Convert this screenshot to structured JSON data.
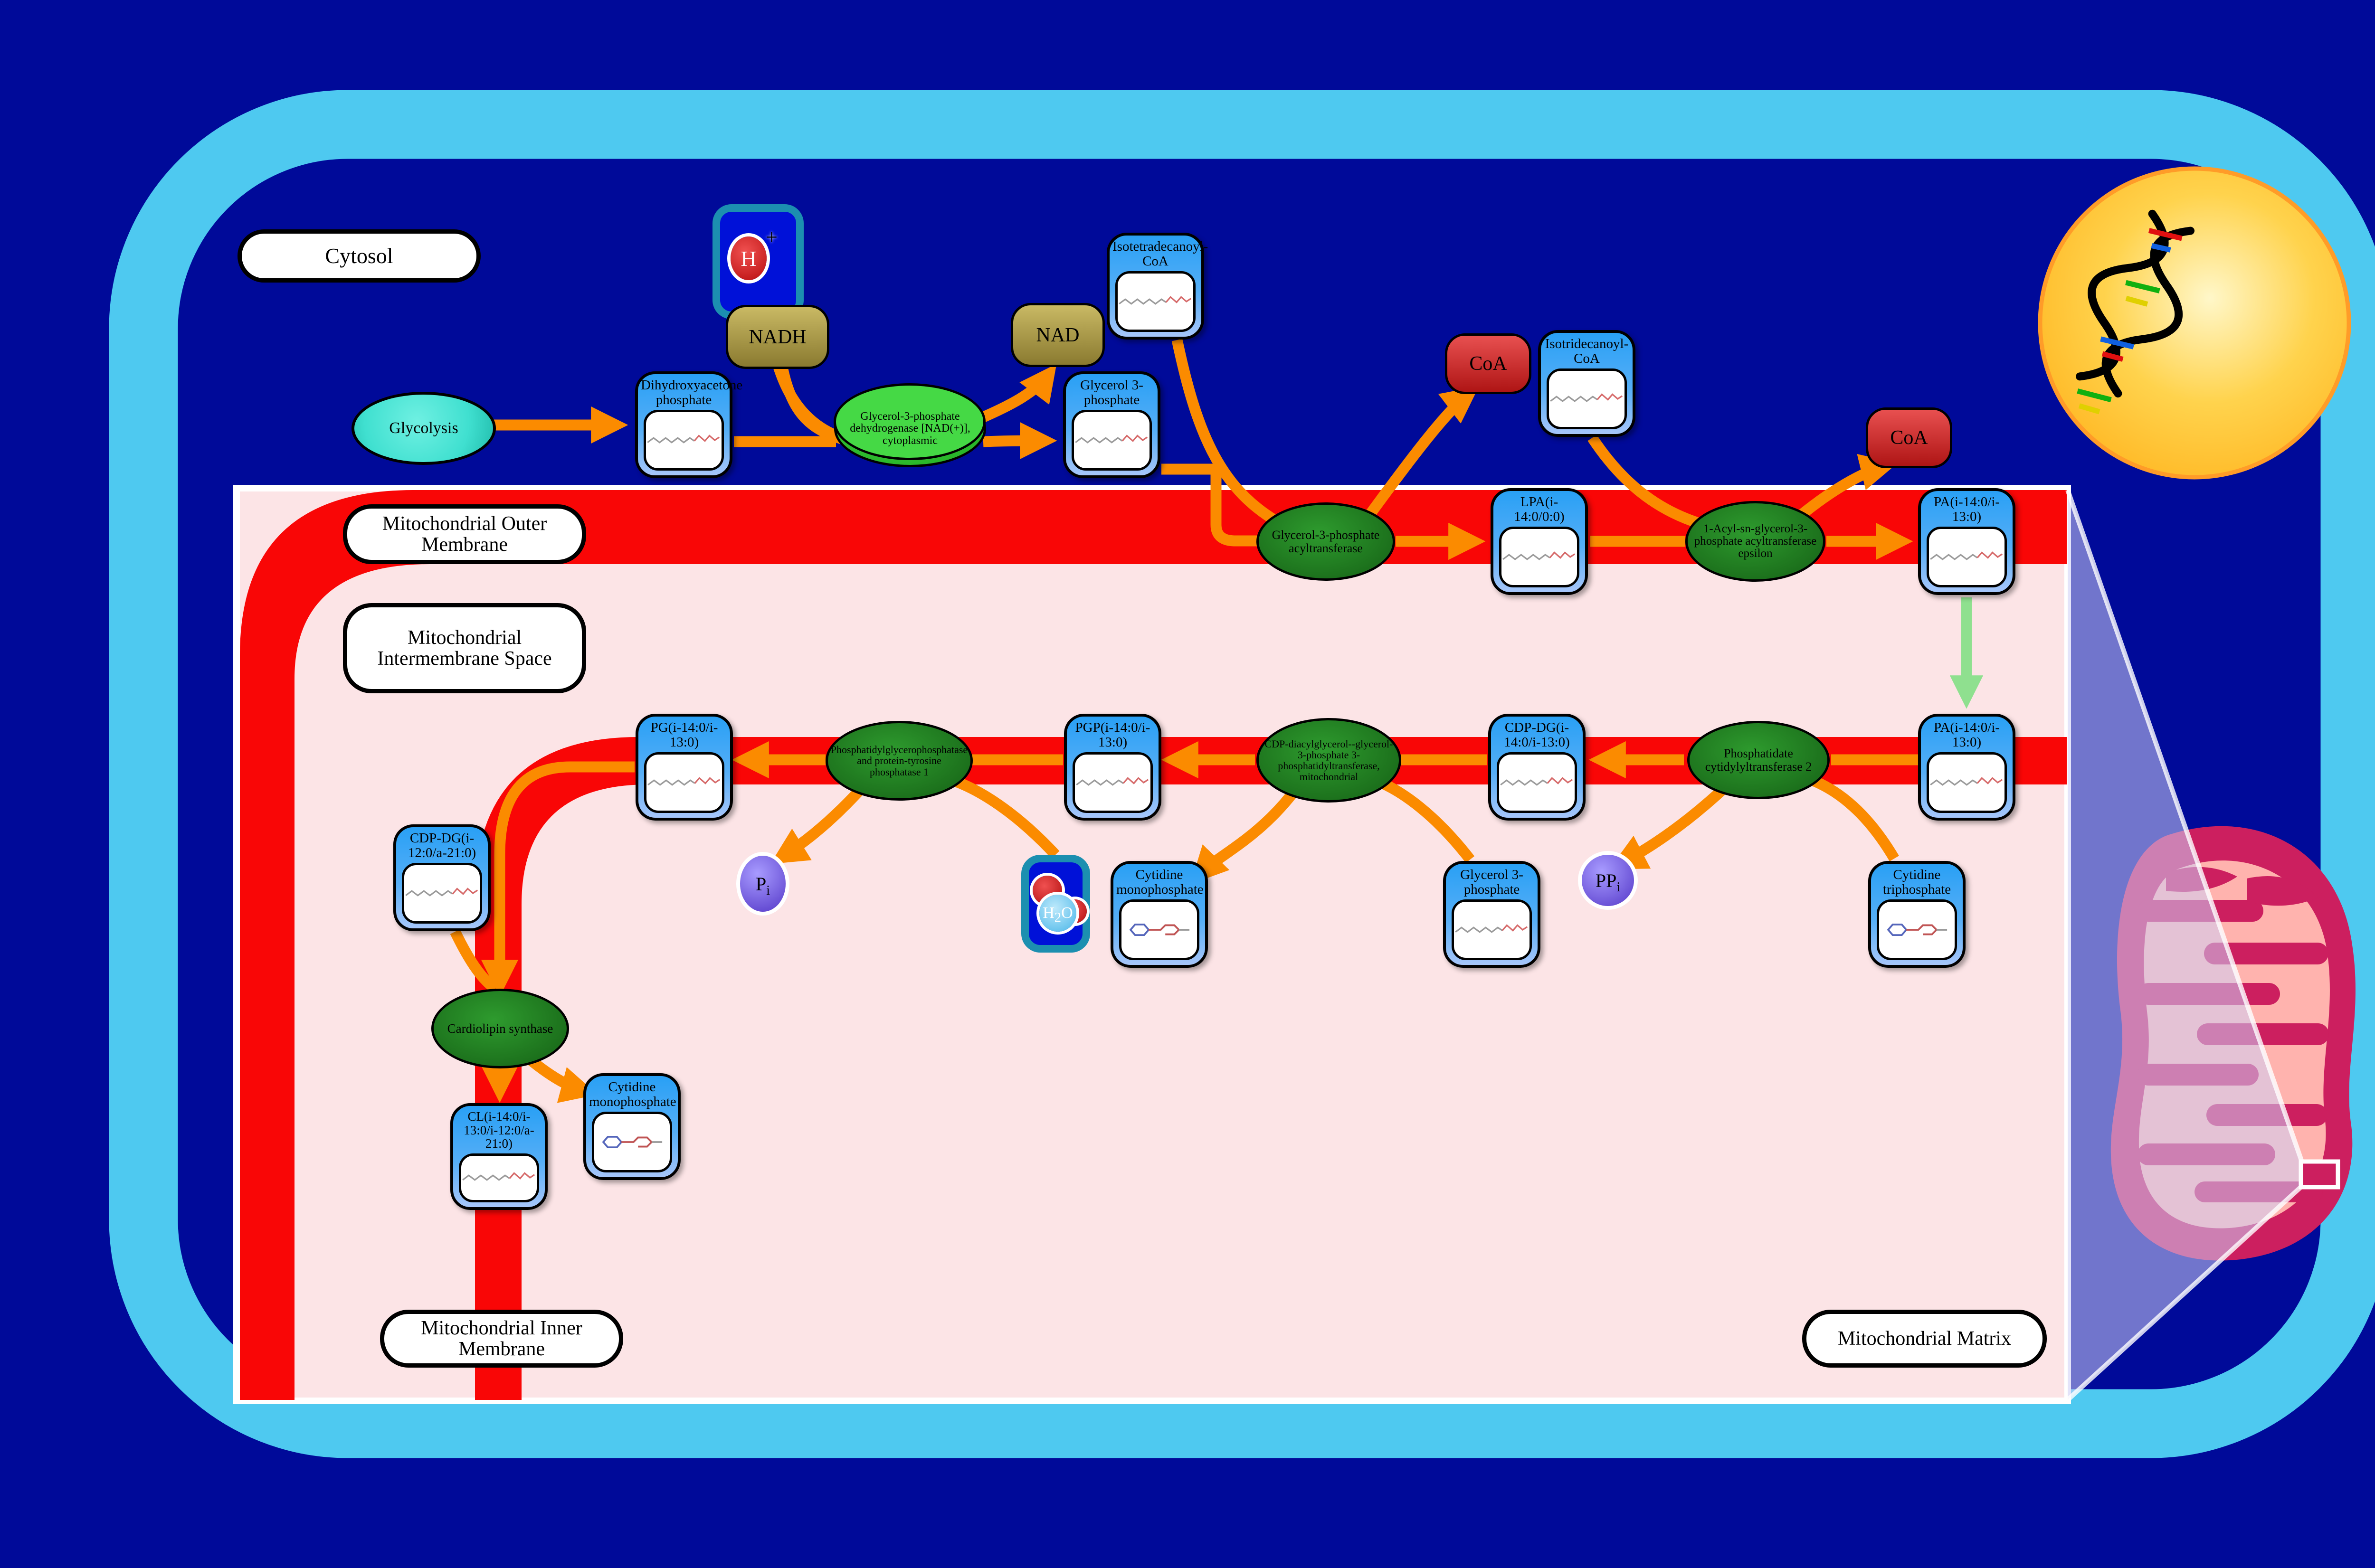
{
  "compartments": {
    "cytosol": "Cytosol",
    "outer_membrane": "Mitochondrial Outer Membrane",
    "intermembrane": "Mitochondrial Intermembrane Space",
    "inner_membrane": "Mitochondrial Inner Membrane",
    "matrix": "Mitochondrial Matrix"
  },
  "pathway": {
    "glycolysis": "Glycolysis"
  },
  "metabolites": {
    "dhap": {
      "title": "Dihydroxyacetone phosphate"
    },
    "g3p": {
      "title": "Glycerol 3-phosphate"
    },
    "iso14coa": {
      "title": "Isotetradecanoyl-CoA"
    },
    "iso13coa": {
      "title": "Isotridecanoyl-CoA"
    },
    "lpa": {
      "title": "LPA(i-14:0/0:0)"
    },
    "pa_outer": {
      "title": "PA(i-14:0/i-13:0)"
    },
    "pa_inner": {
      "title": "PA(i-14:0/i-13:0)"
    },
    "cdp_dg": {
      "title": "CDP-DG(i-14:0/i-13:0)"
    },
    "pgp": {
      "title": "PGP(i-14:0/i-13:0)"
    },
    "pg": {
      "title": "PG(i-14:0/i-13:0)"
    },
    "cdp_dg2": {
      "title": "CDP-DG(i-12:0/a-21:0)"
    },
    "cl": {
      "title": "CL(i-14:0/i-13:0/i-12:0/a-21:0)"
    },
    "cmp_mid": {
      "title": "Cytidine monophosphate"
    },
    "cmp_bottom": {
      "title": "Cytidine monophosphate"
    },
    "g3p_matrix": {
      "title": "Glycerol 3-phosphate"
    },
    "ctp": {
      "title": "Cytidine triphosphate"
    }
  },
  "enzymes": {
    "gpd": {
      "label": "Glycerol-3-phosphate dehydrogenase [NAD(+)], cytoplasmic"
    },
    "gpat": {
      "label": "Glycerol-3-phosphate acyltransferase"
    },
    "agpat": {
      "label": "1-Acyl-sn-glycerol-3-phosphate acyltransferase epsilon"
    },
    "pcyt2": {
      "label": "Phosphatidate cytidylyltransferase 2"
    },
    "pgs1": {
      "label": "CDP-diacylglycerol--glycerol-3-phosphate 3-phosphatidyltransferase, mitochondrial"
    },
    "ptpmt1": {
      "label": "Phosphatidylglycerophosphatase and protein-tyrosine phosphatase 1"
    },
    "crls": {
      "label": "Cardiolipin synthase"
    }
  },
  "small_molecules": {
    "nadh": "NADH",
    "nad": "NAD",
    "coa_1": "CoA",
    "coa_2": "CoA",
    "h_ion": {
      "symbol": "H",
      "charge": "+"
    },
    "h2o": {
      "h": "H",
      "sub": "2",
      "o": "O"
    },
    "pi": {
      "base": "P",
      "sub": "i"
    },
    "ppi": {
      "base": "PP",
      "sub": "i"
    }
  },
  "colors": {
    "background_blue": "#000A99",
    "cell_frame_blue": "#4EC9F0",
    "membrane_red": "#F90606",
    "intermembrane_pink": "#FCE4E6",
    "metabolite_node_blue": "#29A0F5",
    "enzyme_green": "#2E9B2E",
    "arrow_orange": "#FB8B00",
    "transport_arrow_green": "#8FE08F",
    "coa_red": "#E85050",
    "nad_khaki": "#C9B964",
    "phosphate_purple": "#7B5FE0",
    "nucleus_yellow": "#FFC42E",
    "mitochondrion_crimson": "#CC1F5F",
    "mitochondrion_salmon": "#FFB3AE",
    "glycolysis_cyan": "#40E0D0"
  }
}
